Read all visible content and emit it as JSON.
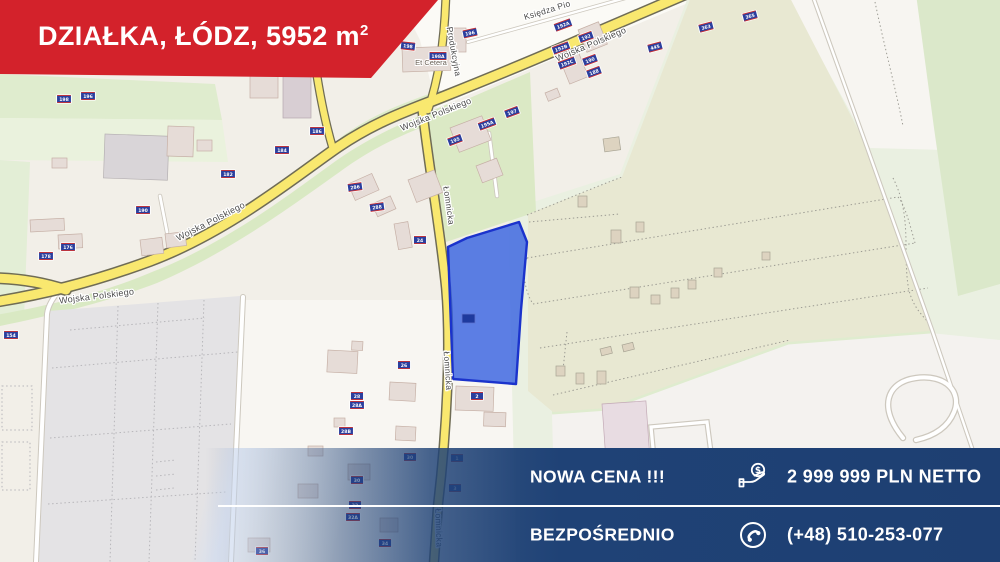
{
  "top_banner": {
    "title_main": "DZIAŁKA, ŁÓDZ, 5952 m",
    "title_sup": "2"
  },
  "bottom_banner": {
    "price_label": "NOWA CENA !!!",
    "price_value": "2 999 999 PLN NETTO",
    "contact_label": "BEZPOŚREDNIO",
    "contact_value": "(+48) 510-253-077"
  },
  "colors": {
    "banner_red": "#d3222b",
    "banner_navy": "#1f4276",
    "plot_fill": "#2f5ce0",
    "plot_stroke": "#1b33cc",
    "road_yellow": "#f9e86f",
    "marker_blue": "#2b3f9e"
  },
  "map": {
    "plot": {
      "points": "448,247 467,238 519,222 527,242 521,310 516,384 453,379",
      "marker": {
        "x": 462,
        "y": 314,
        "w": 13,
        "h": 9,
        "label": ""
      }
    },
    "street_labels": [
      {
        "text": "Wojska Polskiego",
        "x": 97,
        "y": 299,
        "rot": -7,
        "size": 9
      },
      {
        "text": "Wojska Polskiego",
        "x": 212,
        "y": 224,
        "rot": -27,
        "size": 9
      },
      {
        "text": "Wojska Polskiego",
        "x": 437,
        "y": 117,
        "rot": -22,
        "size": 9
      },
      {
        "text": "Wojska Polskiego",
        "x": 592,
        "y": 47,
        "rot": -23,
        "size": 9
      },
      {
        "text": "Łomnicka",
        "x": 446,
        "y": 206,
        "rot": 82,
        "size": 8.5
      },
      {
        "text": "Łomnicka",
        "x": 445,
        "y": 371,
        "rot": 86,
        "size": 8.5
      },
      {
        "text": "Łomnicka",
        "x": 436,
        "y": 528,
        "rot": 88,
        "size": 8.5
      },
      {
        "text": "Produkcyjna",
        "x": 451,
        "y": 52,
        "rot": 80,
        "size": 8.5
      },
      {
        "text": "Księdza Pio",
        "x": 548,
        "y": 13,
        "rot": -17,
        "size": 8.5
      }
    ],
    "place_labels": [
      {
        "text": "Et Cetera",
        "x": 431,
        "y": 65,
        "rot": 0,
        "size": 7.5
      }
    ],
    "address_markers": [
      {
        "x": 64,
        "y": 99,
        "t": "198",
        "r": 0
      },
      {
        "x": 88,
        "y": 96,
        "t": "196",
        "r": 0
      },
      {
        "x": 317,
        "y": 131,
        "t": "186",
        "r": 0
      },
      {
        "x": 282,
        "y": 150,
        "t": "184",
        "r": 0
      },
      {
        "x": 228,
        "y": 174,
        "t": "182",
        "r": 0
      },
      {
        "x": 143,
        "y": 210,
        "t": "190",
        "r": 0
      },
      {
        "x": 46,
        "y": 256,
        "t": "178",
        "r": 0
      },
      {
        "x": 68,
        "y": 247,
        "t": "176",
        "r": 0
      },
      {
        "x": 11,
        "y": 335,
        "t": "154",
        "r": 0
      },
      {
        "x": 408,
        "y": 46,
        "t": "198",
        "r": 6
      },
      {
        "x": 470,
        "y": 33,
        "t": "196",
        "r": -12
      },
      {
        "x": 438,
        "y": 56,
        "t": "198A",
        "r": 0
      },
      {
        "x": 563,
        "y": 25,
        "t": "192A",
        "r": -20
      },
      {
        "x": 586,
        "y": 37,
        "t": "192",
        "r": -20
      },
      {
        "x": 561,
        "y": 48,
        "t": "192B",
        "r": -20
      },
      {
        "x": 590,
        "y": 60,
        "t": "190",
        "r": -20
      },
      {
        "x": 567,
        "y": 63,
        "t": "192C",
        "r": -20
      },
      {
        "x": 594,
        "y": 72,
        "t": "188",
        "r": -20
      },
      {
        "x": 655,
        "y": 47,
        "t": "445",
        "r": -15
      },
      {
        "x": 706,
        "y": 27,
        "t": "363",
        "r": -15
      },
      {
        "x": 750,
        "y": 16,
        "t": "365",
        "r": -15
      },
      {
        "x": 455,
        "y": 140,
        "t": "195",
        "r": -20
      },
      {
        "x": 487,
        "y": 124,
        "t": "195A",
        "r": -20
      },
      {
        "x": 512,
        "y": 112,
        "t": "197",
        "r": -20
      },
      {
        "x": 355,
        "y": 187,
        "t": "286",
        "r": -8
      },
      {
        "x": 377,
        "y": 207,
        "t": "288",
        "r": -8
      },
      {
        "x": 420,
        "y": 240,
        "t": "24",
        "r": 0
      },
      {
        "x": 404,
        "y": 365,
        "t": "26",
        "r": 0
      },
      {
        "x": 357,
        "y": 396,
        "t": "28",
        "r": 0
      },
      {
        "x": 357,
        "y": 405,
        "t": "28A",
        "r": 0
      },
      {
        "x": 346,
        "y": 431,
        "t": "28B",
        "r": 0
      },
      {
        "x": 477,
        "y": 396,
        "t": "2",
        "r": 0
      },
      {
        "x": 410,
        "y": 457,
        "t": "30",
        "r": 0
      },
      {
        "x": 457,
        "y": 458,
        "t": "1",
        "r": 0
      },
      {
        "x": 455,
        "y": 488,
        "t": "3",
        "r": 0
      },
      {
        "x": 357,
        "y": 480,
        "t": "30",
        "r": 0
      },
      {
        "x": 355,
        "y": 505,
        "t": "32",
        "r": 0
      },
      {
        "x": 353,
        "y": 517,
        "t": "32A",
        "r": 0
      },
      {
        "x": 385,
        "y": 543,
        "t": "34",
        "r": 0
      },
      {
        "x": 262,
        "y": 551,
        "t": "36",
        "r": 0
      }
    ]
  }
}
